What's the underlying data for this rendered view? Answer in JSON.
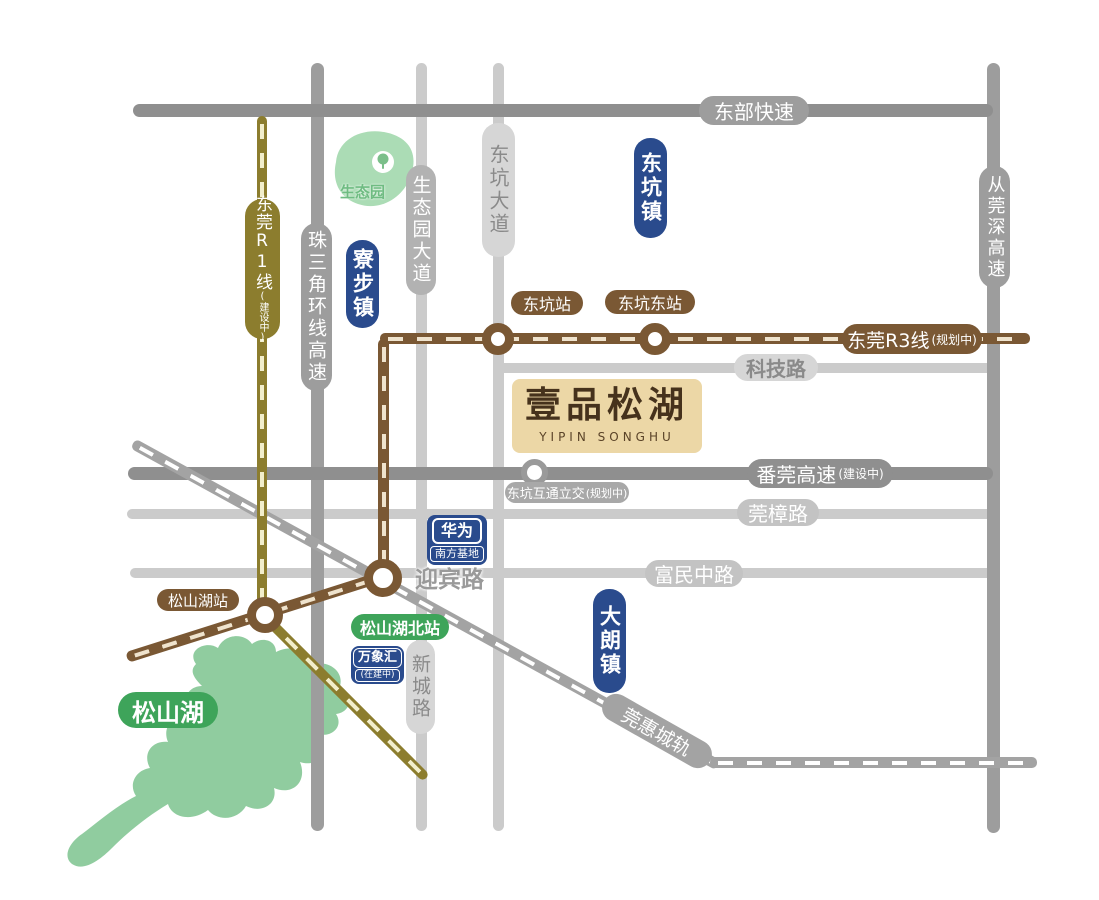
{
  "project": {
    "title": "壹品松湖",
    "subtitle": "YIPIN SONGHU"
  },
  "towns": {
    "dongkeng": {
      "label": "东坑镇"
    },
    "liaobu": {
      "label": "寮步镇"
    },
    "dalang": {
      "label": "大朗镇"
    }
  },
  "roads": {
    "dongbu": {
      "label": "东部快速"
    },
    "keji": {
      "label": "科技路"
    },
    "fanguan": {
      "label": "番莞高速",
      "status": "(建设中)"
    },
    "guanzhang": {
      "label": "莞樟路"
    },
    "yingbin": {
      "label": "迎宾路"
    },
    "fumin": {
      "label": "富民中路"
    },
    "zhusanjiao": {
      "label": "珠三角环线高速"
    },
    "shengtaiyuan": {
      "label": "生态园大道"
    },
    "dongkengdadao": {
      "label": "东坑大道"
    },
    "congguanshen": {
      "label": "从莞深高速"
    },
    "xincheng": {
      "label": "新城路"
    }
  },
  "rails": {
    "r1": {
      "label": "东莞R1线",
      "status": "(建设中)"
    },
    "r3": {
      "label": "东莞R3线",
      "status": "(规划中)"
    },
    "guanhui": {
      "label": "莞惠城轨"
    }
  },
  "stations": {
    "dongkeng": {
      "label": "东坑站"
    },
    "dongkengeast": {
      "label": "东坑东站"
    },
    "songshanhu": {
      "label": "松山湖站"
    },
    "songshanhunorth": {
      "label": "松山湖北站"
    },
    "interchange": {
      "label": "东坑互通立交",
      "status": "(规划中)"
    }
  },
  "pois": {
    "huawei": {
      "label": "华为",
      "sublabel": "南方基地"
    },
    "wanxianghui": {
      "label": "万象汇",
      "status": "(在建中)"
    },
    "ecopark": {
      "label": "生态园"
    },
    "lake": {
      "label": "松山湖"
    }
  },
  "colors": {
    "road_dark": "#8f8f8f",
    "road_medium": "#9d9d9d",
    "road_light": "#cbcbcb",
    "road_pale": "#d6d6d6",
    "rail_r1": "#8c7d2e",
    "rail_r1_dash": "#f2eecb",
    "rail_r3": "#7a5834",
    "rail_r3_dash": "#efe3cd",
    "rail_guanhui": "#a3a3a3",
    "rail_guanhui_dash": "#ffffff",
    "town_blue": "#2a4b8d",
    "station_green": "#3ea45a",
    "lake_green": "#90cc9f",
    "park_green": "#abdcb5",
    "project_bg": "#ecd7a6",
    "project_text": "#46321c"
  }
}
